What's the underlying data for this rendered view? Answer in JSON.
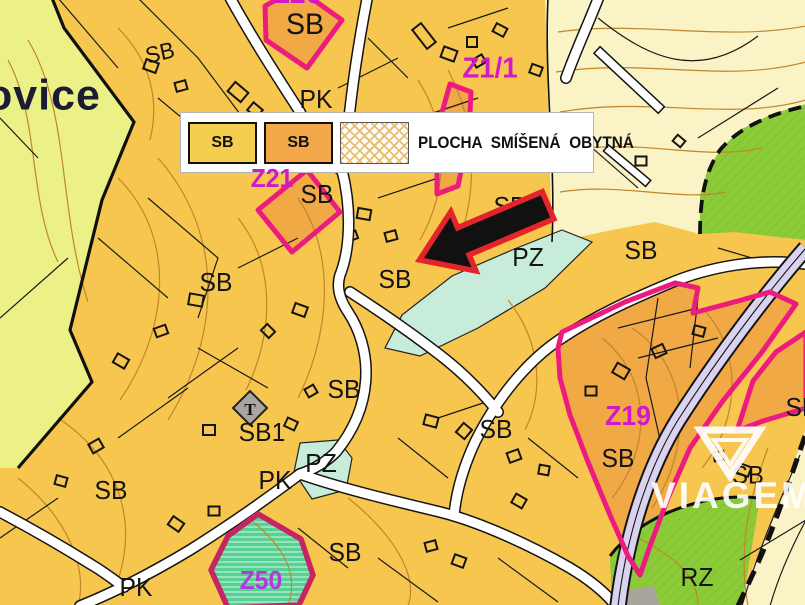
{
  "place_name_fragment": "ovice",
  "legend": {
    "title": "PLOCHA SMÍŠENÁ OBYTNÁ",
    "items": [
      {
        "label": "SB",
        "style": "yellow"
      },
      {
        "label": "SB",
        "style": "orange"
      },
      {
        "label": "",
        "style": "hatched"
      }
    ]
  },
  "watermark": {
    "name": "VIAGEM"
  },
  "symbols": {
    "church_marker": "T"
  },
  "labels": [
    {
      "text": "SB"
    },
    {
      "text": "Z20"
    },
    {
      "text": "SB"
    },
    {
      "text": "PK"
    },
    {
      "text": "Z21"
    },
    {
      "text": "SB"
    },
    {
      "text": "Z1/1"
    },
    {
      "text": "SB"
    },
    {
      "text": "PZ"
    },
    {
      "text": "SB"
    },
    {
      "text": "SB"
    },
    {
      "text": "SB"
    },
    {
      "text": "SB"
    },
    {
      "text": "SB1"
    },
    {
      "text": "SB"
    },
    {
      "text": "Z19"
    },
    {
      "text": "SB"
    },
    {
      "text": "SB"
    },
    {
      "text": "SB"
    },
    {
      "text": "PZ"
    },
    {
      "text": "PK"
    },
    {
      "text": "SB"
    },
    {
      "text": "SB"
    },
    {
      "text": "Z50"
    },
    {
      "text": "PK"
    },
    {
      "text": "RZ"
    }
  ],
  "colors": {
    "sb_yellow": "#f6c64f",
    "sb_orange": "#f1a946",
    "pale_green": "#ecf187",
    "cream": "#faf3c6",
    "green_hatched": "#8bcb38",
    "z50_green": "#57d093",
    "teal_pz": "#c8ecda",
    "lavender_road": "#d9d3f0",
    "contour_brown": "#c0862b",
    "zone_border_pink": "#ec1c7f",
    "z50_border": "#c62563",
    "zone_label_magenta": "#d318c9",
    "arrow_red": "#e3242b",
    "place_name_navy": "#1b1c33"
  }
}
